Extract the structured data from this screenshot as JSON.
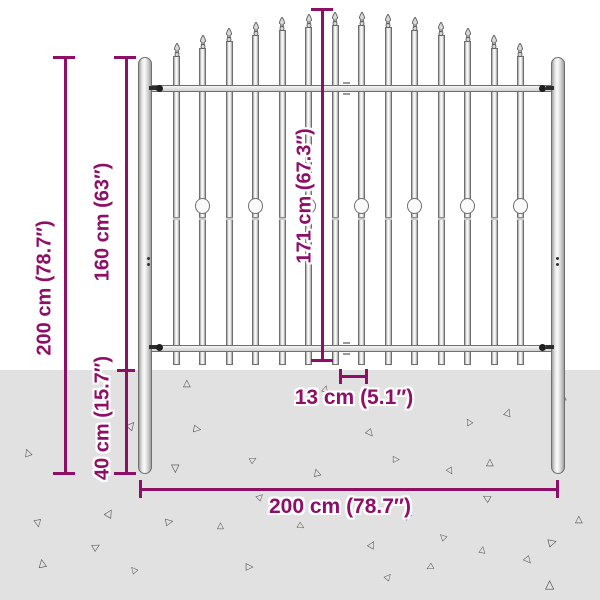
{
  "labels": {
    "total_height": "200 cm (78.7″)",
    "above_ground_height": "160 cm (63″)",
    "below_ground_depth": "40 cm (15.7″)",
    "panel_height": "171 cm (67.3″)",
    "bar_spacing": "13 cm (5.1″)",
    "total_width": "200 cm (78.7″)"
  },
  "colors": {
    "dimension_magenta": "#8d0f66",
    "ground_gray": "#e1e1e1",
    "steel_outline": "#6f6f6f",
    "steel_light": "#f2f2f2",
    "triangle_gray": "#4a4a4a"
  },
  "fence": {
    "bar_count": 14,
    "first_bar_x": 176.5,
    "bar_pitch": 26.46,
    "bar_bottom": 365,
    "finial_height": 13,
    "notch_y": 217,
    "ornament_y": 198,
    "bars": [
      {
        "tip": 43,
        "ornament": false
      },
      {
        "tip": 35,
        "ornament": true
      },
      {
        "tip": 28,
        "ornament": false
      },
      {
        "tip": 22,
        "ornament": true
      },
      {
        "tip": 17,
        "ornament": false
      },
      {
        "tip": 14,
        "ornament": true
      },
      {
        "tip": 12,
        "ornament": false
      },
      {
        "tip": 12,
        "ornament": true
      },
      {
        "tip": 14,
        "ornament": false
      },
      {
        "tip": 17,
        "ornament": true
      },
      {
        "tip": 22,
        "ornament": false
      },
      {
        "tip": 28,
        "ornament": true
      },
      {
        "tip": 35,
        "ornament": false
      },
      {
        "tip": 43,
        "ornament": true
      }
    ]
  },
  "ground": {
    "top": 370,
    "triangle_glyph": "△",
    "triangles": [
      [
        183,
        379,
        10,
        0
      ],
      [
        322,
        384,
        9,
        15
      ],
      [
        559,
        392,
        10,
        0
      ],
      [
        127,
        420,
        11,
        40
      ],
      [
        193,
        424,
        10,
        100
      ],
      [
        504,
        408,
        10,
        20
      ],
      [
        465,
        417,
        9,
        -30
      ],
      [
        366,
        428,
        10,
        140
      ],
      [
        24,
        448,
        10,
        -20
      ],
      [
        250,
        455,
        9,
        60
      ],
      [
        171,
        463,
        11,
        180
      ],
      [
        393,
        455,
        9,
        90
      ],
      [
        486,
        458,
        10,
        0
      ],
      [
        313,
        468,
        10,
        -15
      ],
      [
        447,
        467,
        9,
        150
      ],
      [
        257,
        492,
        9,
        45
      ],
      [
        483,
        493,
        10,
        -60
      ],
      [
        105,
        508,
        11,
        30
      ],
      [
        34,
        518,
        10,
        170
      ],
      [
        165,
        517,
        10,
        80
      ],
      [
        217,
        521,
        9,
        0
      ],
      [
        575,
        515,
        10,
        0
      ],
      [
        298,
        522,
        9,
        120
      ],
      [
        404,
        513,
        9,
        200
      ],
      [
        92,
        542,
        10,
        60
      ],
      [
        38,
        558,
        11,
        -10
      ],
      [
        245,
        562,
        10,
        90
      ],
      [
        368,
        540,
        10,
        30
      ],
      [
        439,
        532,
        9,
        -45
      ],
      [
        479,
        545,
        9,
        10
      ],
      [
        548,
        537,
        11,
        75
      ],
      [
        524,
        555,
        10,
        140
      ],
      [
        426,
        563,
        9,
        -120
      ],
      [
        385,
        572,
        9,
        40
      ],
      [
        545,
        578,
        12,
        0
      ],
      [
        130,
        565,
        9,
        -40
      ]
    ]
  }
}
